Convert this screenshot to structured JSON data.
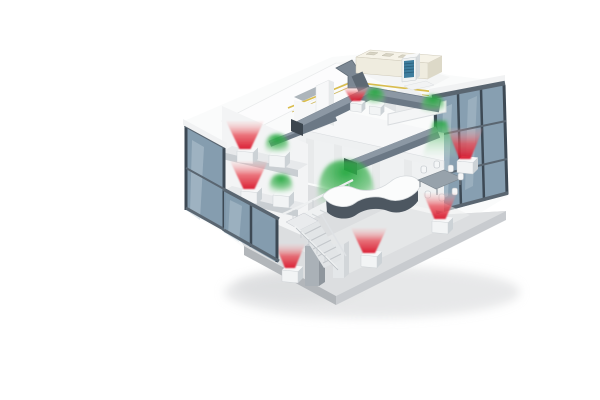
{
  "scene_name": "hvac-office-cutaway-illustration",
  "palette": {
    "background": "#ffffff",
    "heat_strong": "#d8142a",
    "heat_mid": "#e84852",
    "heat_soft": "#f6b6b6",
    "cool_strong": "#1ea53a",
    "cool_mid": "#4cb85e",
    "cool_soft": "#c2e8c6",
    "glass": "#7e98ab",
    "glass_hi": "#bccdd7",
    "frame_dark": "#3d4954",
    "frame_mid": "#5a6671",
    "duct": "#6b7885",
    "duct_hi": "#8c98a4",
    "duct_cap": "#3c464f",
    "wall": "#f3f4f5",
    "wall_shade": "#e2e4e6",
    "slab": "#c9ced2",
    "floor": "#dcdee0",
    "floor_edge_left": "#b2b6ba",
    "floor_edge_right": "#c8cbcf",
    "ahu": "#efecdf",
    "ahu_top": "#f6f3e8",
    "ahu_side": "#ddd9c8",
    "outdoor_grille": "#3e7d9e",
    "pipe": "#d9bd4e",
    "unit_body": "#f2f4f5",
    "unit_side": "#ccd2d6",
    "unit_top": "#f7f8f9",
    "desk_front": "#4d5761",
    "desk_top": "#fbfcfc",
    "table_top": "#97a2ab",
    "shadow": "#d0d2d4"
  },
  "airflows": [
    {
      "id": "heating-flow-wing-upper",
      "mode": "heating",
      "shape": "cone-up",
      "x": 245,
      "y": 151,
      "tw": 38,
      "bw": 11,
      "h": 28,
      "unit": true
    },
    {
      "id": "cooling-flow-wing-upper",
      "mode": "cooling",
      "shape": "dome",
      "x": 277,
      "y": 155,
      "w": 24,
      "h": 19,
      "unit": true
    },
    {
      "id": "heating-flow-wing-lower",
      "mode": "heating",
      "shape": "cone-up",
      "x": 249,
      "y": 191,
      "tw": 38,
      "bw": 11,
      "h": 28,
      "unit": true
    },
    {
      "id": "cooling-flow-wing-lower",
      "mode": "cooling",
      "shape": "dome",
      "x": 281,
      "y": 195,
      "w": 24,
      "h": 19,
      "unit": true
    },
    {
      "id": "heating-flow-upper-room",
      "mode": "heating",
      "shape": "cone-up",
      "x": 356,
      "y": 103,
      "tw": 26,
      "bw": 9,
      "h": 14,
      "unit": true,
      "small": true
    },
    {
      "id": "cooling-flow-upper-room",
      "mode": "cooling",
      "shape": "dome",
      "x": 375,
      "y": 106,
      "w": 20,
      "h": 16,
      "unit": true,
      "small": true
    },
    {
      "id": "cooling-flow-balcony",
      "mode": "cooling",
      "shape": "dome",
      "x": 433,
      "y": 112,
      "w": 24,
      "h": 17
    },
    {
      "id": "cooling-flow-window-right",
      "mode": "cooling",
      "shape": "cone-down",
      "x": 440,
      "y": 121,
      "tw": 12,
      "bw": 36,
      "h": 37
    },
    {
      "id": "heating-flow-window-right",
      "mode": "heating",
      "shape": "cone-up",
      "x": 465,
      "y": 161,
      "tw": 36,
      "bw": 11,
      "h": 31,
      "unit": true
    },
    {
      "id": "cooling-flow-reception",
      "mode": "cooling",
      "shape": "dome",
      "x": 346,
      "y": 208,
      "w": 58,
      "h": 48,
      "layer": "back"
    },
    {
      "id": "heating-flow-meeting",
      "mode": "heating",
      "shape": "cone-up",
      "x": 440,
      "y": 221,
      "tw": 34,
      "bw": 11,
      "h": 26,
      "unit": true
    },
    {
      "id": "heating-flow-center",
      "mode": "heating",
      "shape": "cone-up",
      "x": 369,
      "y": 255,
      "tw": 36,
      "bw": 12,
      "h": 25,
      "unit": true
    },
    {
      "id": "heating-flow-corner",
      "mode": "heating",
      "shape": "cone-up",
      "x": 290,
      "y": 270,
      "tw": 30,
      "bw": 10,
      "h": 24,
      "unit": true
    }
  ]
}
